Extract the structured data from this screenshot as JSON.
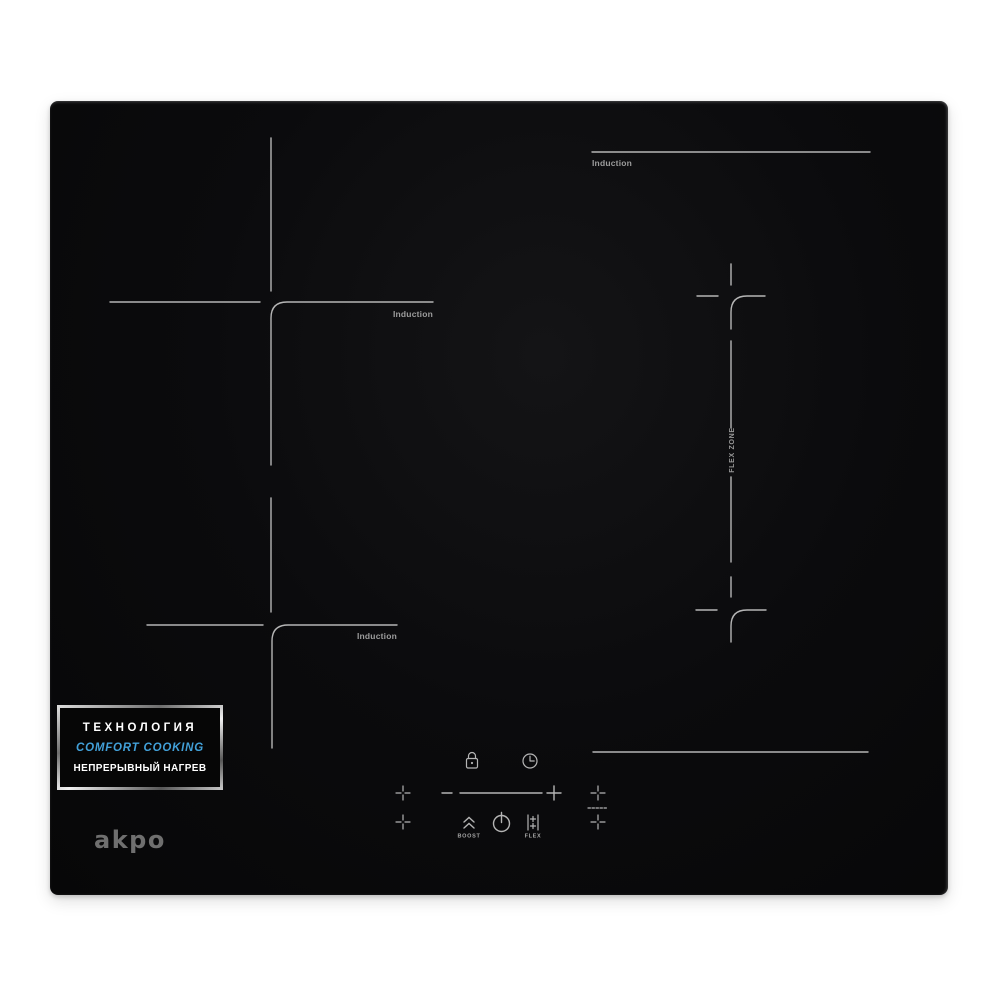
{
  "product": {
    "brand_logo": "akpo",
    "type": "induction-cooktop-photo"
  },
  "badge": {
    "title": "ТЕХНОЛОГИЯ",
    "subtitle": "COMFORT COOKING",
    "caption": "НЕПРЕРЫВНЫЙ НАГРЕВ"
  },
  "zones": {
    "mid_left": {
      "label": "Induction"
    },
    "bottom_left": {
      "label": "Induction"
    },
    "right": {
      "label": "Induction"
    },
    "flex": {
      "label": "FLEX ZONE"
    }
  },
  "controls": {
    "lock": {
      "icon": "lock-icon"
    },
    "timer": {
      "icon": "timer-clock-icon"
    },
    "slider": {
      "minus_icon": "minus-icon",
      "plus_icon": "plus-icon",
      "line": "power-slider-line"
    },
    "boost": {
      "label": "BOOST",
      "icon": "boost-chevrons-icon"
    },
    "power": {
      "icon": "power-icon"
    },
    "flex": {
      "label": "FLEX",
      "icon": "flex-bridge-icon"
    },
    "zone_selectors": {
      "left_icons": [
        "zone-select-plus-icon",
        "zone-select-plus-icon"
      ],
      "right_icons": [
        "zone-select-plus-icon",
        "flex-select-dashes",
        "zone-select-plus-icon"
      ]
    }
  },
  "colors": {
    "surface": "#0b0b0d",
    "marking": "#b5b5b5",
    "zone_label_text": "#9d9d9d",
    "badge_accent": "#42a0d8",
    "badge_text": "#ffffff",
    "logo_gray": "#6f6f6f",
    "background": "#ffffff"
  }
}
